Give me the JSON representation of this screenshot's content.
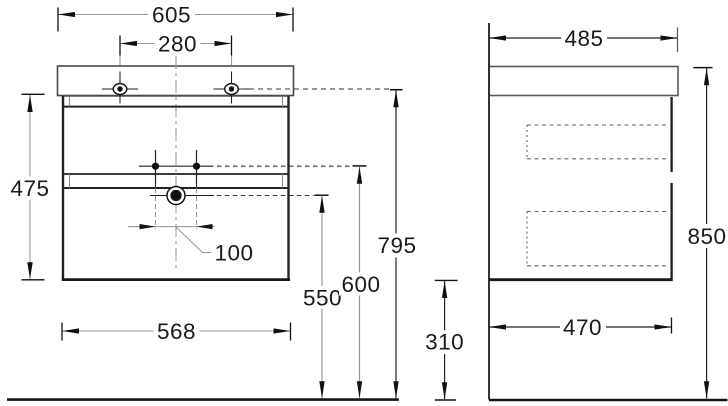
{
  "drawing_type": "vanity cabinet dimensioned technical drawing",
  "colors": {
    "background": "#ffffff",
    "structure": "#222222",
    "dimension_gray": "#999999",
    "dimension_dark": "#1f1f1f",
    "text": "#1a1a1a"
  },
  "front_view": {
    "name": "front-view",
    "dimensions": {
      "washbasin_width": "605",
      "faucet_hole_spacing": "280",
      "cabinet_height": "475",
      "drain_offset": "100",
      "cabinet_width": "568",
      "drain_height": "550",
      "supply_height": "600",
      "washbasin_rim_height": "795"
    }
  },
  "side_view": {
    "name": "side-view",
    "dimensions": {
      "washbasin_depth": "485",
      "overall_height": "850",
      "cabinet_depth": "470",
      "floor_clearance": "310"
    }
  }
}
